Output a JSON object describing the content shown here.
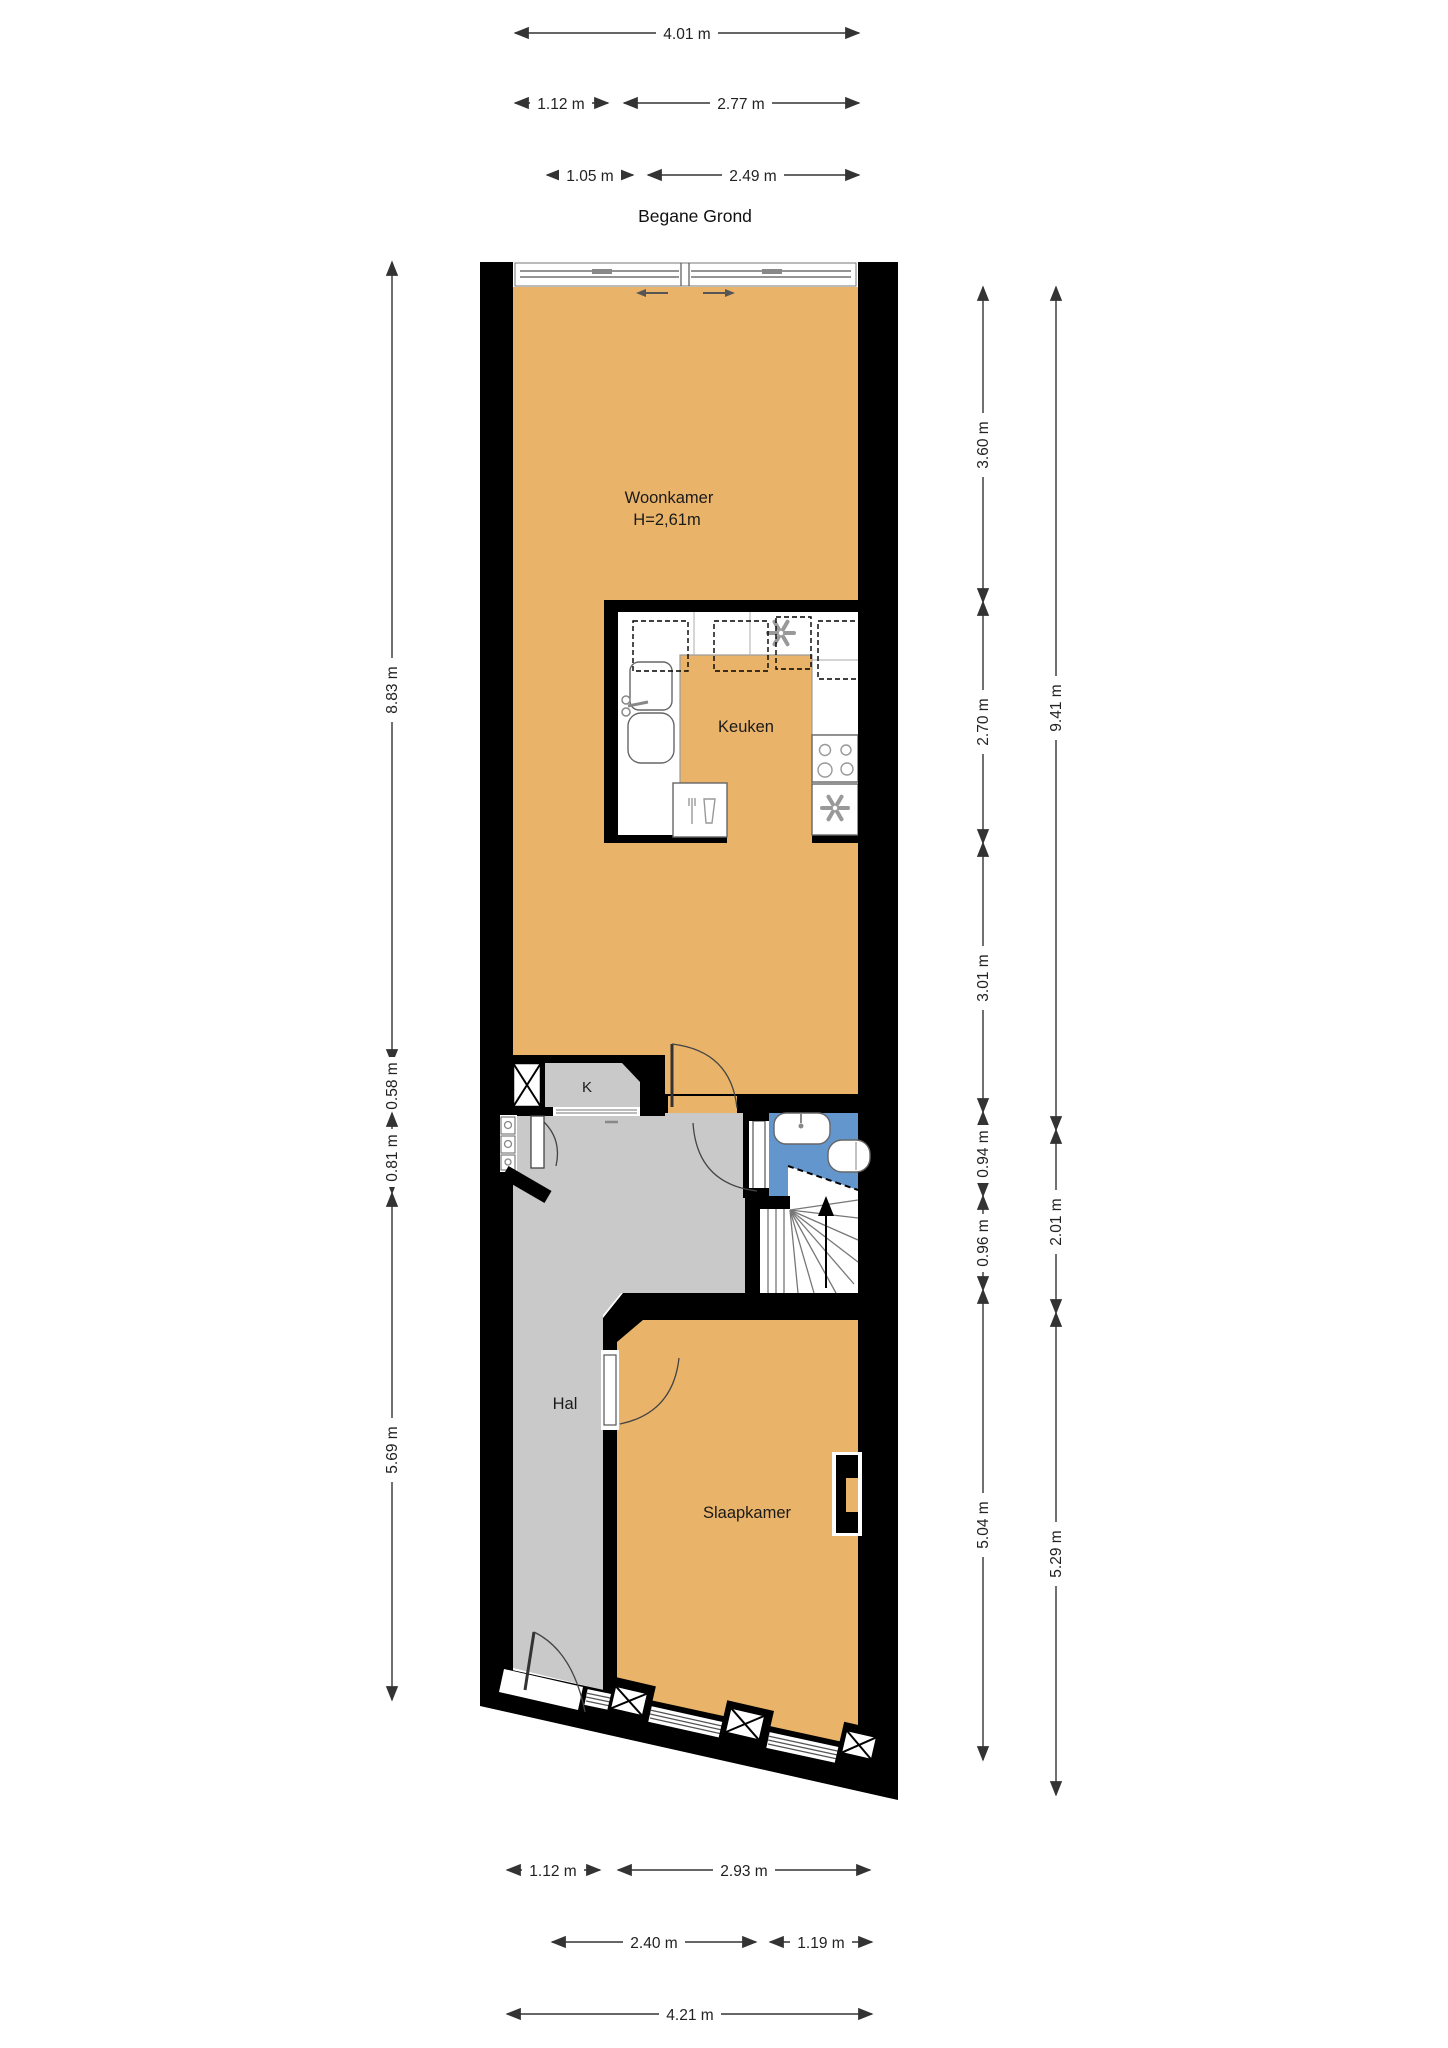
{
  "title": "Begane Grond",
  "rooms": {
    "woonkamer": {
      "name": "Woonkamer",
      "ceiling": "H=2,61m"
    },
    "keuken": {
      "name": "Keuken"
    },
    "hal": {
      "name": "Hal"
    },
    "slaapkamer": {
      "name": "Slaapkamer"
    },
    "kast": {
      "name": "K"
    }
  },
  "dimensions": {
    "top": {
      "total": "4.01 m",
      "row2_left": "1.12 m",
      "row2_right": "2.77 m",
      "row3_left": "1.05 m",
      "row3_right": "2.49 m"
    },
    "left": {
      "woonkamer": "8.83 m",
      "kast": "0.58 m",
      "entree": "0.81 m",
      "hal": "5.69 m"
    },
    "right_inner": {
      "woonkamer_top": "3.60 m",
      "keuken": "2.70 m",
      "woonkamer_bottom": "3.01 m",
      "badkamer": "0.94 m",
      "trap": "0.96 m",
      "slaapkamer": "5.04 m"
    },
    "right_outer": {
      "top": "9.41 m",
      "mid": "2.01 m",
      "bottom": "5.29 m"
    },
    "bottom": {
      "row1_left": "1.12 m",
      "row1_right": "2.93 m",
      "row2_left": "2.40 m",
      "row2_right": "1.19 m",
      "total": "4.21 m"
    }
  },
  "colors": {
    "floor": "#E9B469",
    "hall_floor": "#C9C9C9",
    "bathroom_floor": "#6496CE",
    "walls": "#000000",
    "background": "#FFFFFF"
  }
}
